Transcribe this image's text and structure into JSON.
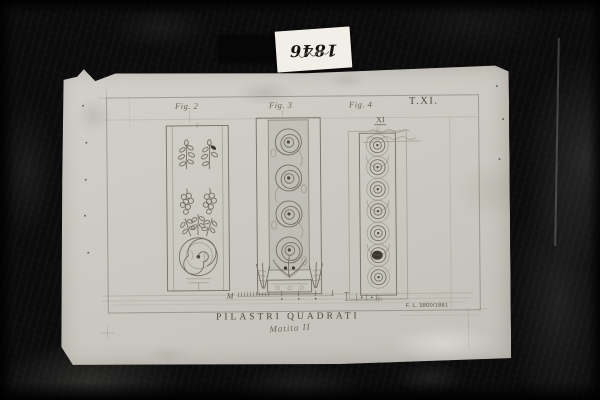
{
  "photo": {
    "background_color": "#0b0b0b",
    "paper_color": "#cdc9c2",
    "pencil_color": "#756f65"
  },
  "archive_label": {
    "year": "1846"
  },
  "drawing": {
    "plate_number": "T.XI.",
    "figures": [
      {
        "label": "Fig. 2"
      },
      {
        "label": "Fig. 3"
      },
      {
        "label": "Fig. 4"
      }
    ],
    "numeral": "XI",
    "scale_label": "M",
    "title": "PILASTRI QUADRATI",
    "subtitle": "Matita II",
    "stamp": "F. L. 5800/1881"
  }
}
